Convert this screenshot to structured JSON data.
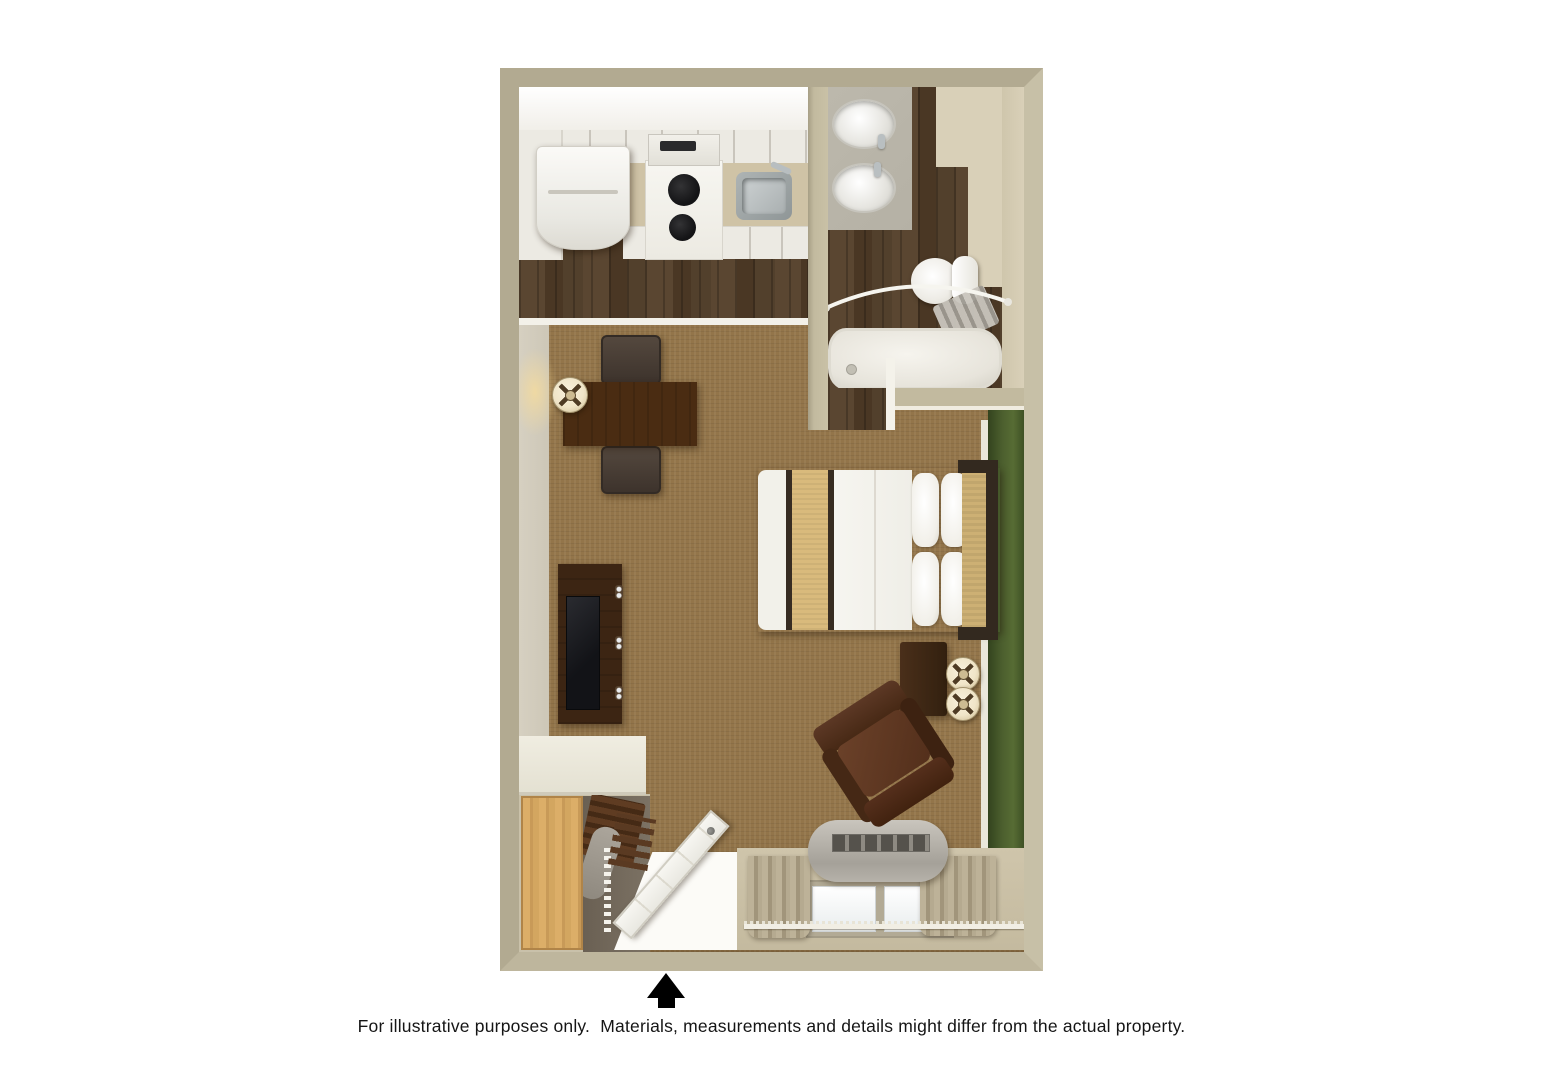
{
  "disclaimer": "For illustrative purposes only.  Materials, measurements and details might differ from the actual property.",
  "entrance_arrow": {
    "meaning": "entrance",
    "direction": "up",
    "glyph": "▲"
  },
  "palette": {
    "page_bg": "#ffffff",
    "wall": "#b2aa91",
    "wall_right": "#c7c0a7",
    "wall_bottom": "#beb69d",
    "wall_face": "#d6d0c1",
    "wood_floor": "#4f3c29",
    "carpet": "#93754a",
    "green_wall": "#4c5f2e",
    "cabinet_white": "#eceae3",
    "counter_tan": "#cfc3a6",
    "counter_gray": "#b5b1a5",
    "vanity_beige": "#d9d0b8",
    "fixture_white": "#f0eee7",
    "dark_wood": "#3c2513",
    "desk_wood": "#4a2c12",
    "leather_brown": "#53301d",
    "bed_stripe": "#372c22",
    "bed_runner": "#d9ba7c",
    "headboard_inset": "#cdb074",
    "lamp_shade": "#f0e5c8",
    "arrow_black": "#000000"
  }
}
